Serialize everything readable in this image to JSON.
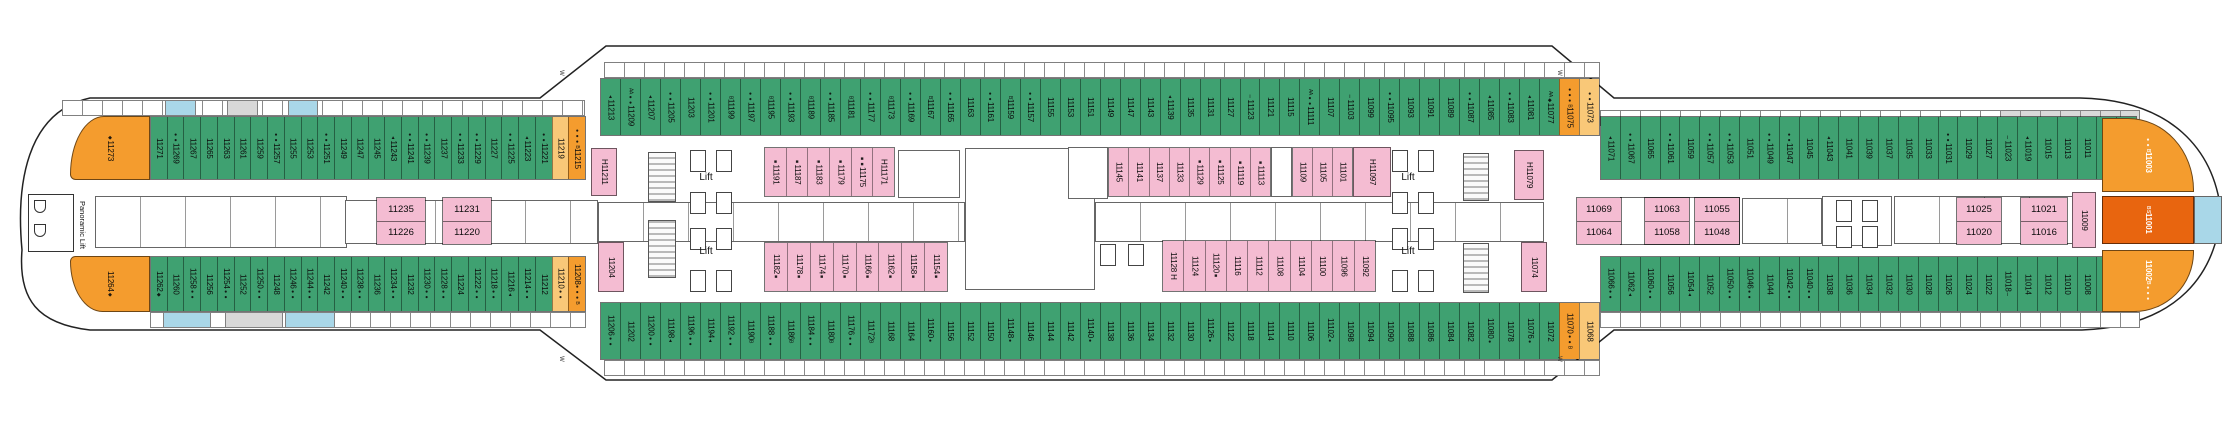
{
  "labels": {
    "lift": "Lift",
    "panoramic_lift": "Panoramic Lift",
    "w_marker": "W"
  },
  "colors": {
    "green": "#3FA171",
    "pink": "#F4BCD2",
    "orange": "#F49C2E",
    "lightorange": "#F9C878",
    "darkorange": "#E8650F",
    "blue": "#A9D7E8",
    "grey": "#D8D8D8"
  },
  "stern": {
    "top": {
      "n": "11273",
      "m": "◆"
    },
    "bottom": {
      "n": "11264",
      "m": "◆"
    }
  },
  "bow": {
    "top": {
      "n": "11003",
      "m": "●● B"
    },
    "middle": {
      "n": "11001",
      "m": "B S"
    },
    "bottom": {
      "n": "11002",
      "m": "B ●●●"
    }
  },
  "rows": {
    "top_left": {
      "cabins": [
        {
          "n": "11271"
        },
        {
          "n": "11269",
          "m": "●●"
        },
        {
          "n": "11267"
        },
        {
          "n": "11265"
        },
        {
          "n": "11263"
        },
        {
          "n": "11261"
        },
        {
          "n": "11259"
        },
        {
          "n": "11257",
          "m": "●●"
        },
        {
          "n": "11255"
        },
        {
          "n": "11253"
        },
        {
          "n": "11251",
          "m": "●●"
        },
        {
          "n": "11249"
        },
        {
          "n": "11247"
        },
        {
          "n": "11245"
        },
        {
          "n": "11243",
          "m": "▲"
        },
        {
          "n": "11241",
          "m": "●●"
        },
        {
          "n": "11239",
          "m": "●●"
        },
        {
          "n": "11237"
        },
        {
          "n": "11233",
          "m": "●●"
        },
        {
          "n": "11229",
          "m": "●●"
        },
        {
          "n": "11227"
        },
        {
          "n": "11225",
          "m": "●●"
        },
        {
          "n": "11223",
          "m": "▲"
        },
        {
          "n": "11221",
          "m": "●●"
        },
        {
          "n": "11219",
          "c": "lightorange"
        },
        {
          "n": "11215",
          "c": "orange",
          "m": "●●● B"
        }
      ]
    },
    "top_center": {
      "cabins": [
        {
          "n": "11213",
          "m": "▲"
        },
        {
          "n": "11209",
          "m": "AA ●●"
        },
        {
          "n": "11207",
          "m": "▲"
        },
        {
          "n": "11205",
          "m": "●●"
        },
        {
          "n": "11203"
        },
        {
          "n": "11201",
          "m": "●●"
        },
        {
          "n": "11199",
          "m": "B"
        },
        {
          "n": "11197",
          "m": "●●"
        },
        {
          "n": "11195",
          "m": "B"
        },
        {
          "n": "11193",
          "m": "●●"
        },
        {
          "n": "11189",
          "m": "B"
        },
        {
          "n": "11185",
          "m": "●●"
        },
        {
          "n": "11181",
          "m": "B"
        },
        {
          "n": "11177",
          "m": "●●"
        },
        {
          "n": "11173",
          "m": "B"
        },
        {
          "n": "11169",
          "m": "●●"
        },
        {
          "n": "11167",
          "m": "B"
        },
        {
          "n": "11165",
          "m": "●●"
        },
        {
          "n": "11163"
        },
        {
          "n": "11161",
          "m": "●●"
        },
        {
          "n": "11159",
          "m": "B"
        },
        {
          "n": "11157",
          "m": "●●"
        },
        {
          "n": "11155"
        },
        {
          "n": "11153"
        },
        {
          "n": "11151"
        },
        {
          "n": "11149"
        },
        {
          "n": "11147"
        },
        {
          "n": "11143"
        },
        {
          "n": "11139",
          "m": "▲"
        },
        {
          "n": "11135"
        },
        {
          "n": "11131"
        },
        {
          "n": "11127"
        },
        {
          "n": "11123",
          "m": "Ⅰ"
        },
        {
          "n": "11121"
        },
        {
          "n": "11115"
        },
        {
          "n": "11111",
          "m": "AA ●●"
        },
        {
          "n": "11107"
        },
        {
          "n": "11103",
          "m": "Ⅰ"
        },
        {
          "n": "11099"
        },
        {
          "n": "11095",
          "m": "●●"
        },
        {
          "n": "11093"
        },
        {
          "n": "11091"
        },
        {
          "n": "11089"
        },
        {
          "n": "11087",
          "m": "●●"
        },
        {
          "n": "11085",
          "m": "▲"
        },
        {
          "n": "11083",
          "m": "●●"
        },
        {
          "n": "11081",
          "m": "▲"
        },
        {
          "n": "11077",
          "m": "AA ◆"
        },
        {
          "n": "11075",
          "c": "orange",
          "m": "●●● B"
        },
        {
          "n": "11073",
          "c": "lightorange",
          "m": "●●"
        }
      ]
    },
    "top_right": {
      "cabins": [
        {
          "n": "11071",
          "m": "▲"
        },
        {
          "n": "11067",
          "m": "●●"
        },
        {
          "n": "11065"
        },
        {
          "n": "11061",
          "m": "●●"
        },
        {
          "n": "11059"
        },
        {
          "n": "11057",
          "m": "●●"
        },
        {
          "n": "11053",
          "m": "●●"
        },
        {
          "n": "11051"
        },
        {
          "n": "11049",
          "m": "●●"
        },
        {
          "n": "11047",
          "m": "●●"
        },
        {
          "n": "11045"
        },
        {
          "n": "11043",
          "m": "▲"
        },
        {
          "n": "11041"
        },
        {
          "n": "11039"
        },
        {
          "n": "11037"
        },
        {
          "n": "11035"
        },
        {
          "n": "11033"
        },
        {
          "n": "11031",
          "m": "●●"
        },
        {
          "n": "11029"
        },
        {
          "n": "11027"
        },
        {
          "n": "11023",
          "m": "Ⅰ"
        },
        {
          "n": "11019",
          "m": "▲"
        },
        {
          "n": "11015"
        },
        {
          "n": "11013"
        },
        {
          "n": "11011"
        },
        {
          "n": "11007"
        },
        {
          "n": "11005"
        }
      ]
    },
    "bottom_left": {
      "cabins": [
        {
          "n": "11262",
          "m": "◆"
        },
        {
          "n": "11260"
        },
        {
          "n": "11258",
          "m": "●●"
        },
        {
          "n": "11256"
        },
        {
          "n": "11254",
          "m": "●●"
        },
        {
          "n": "11252"
        },
        {
          "n": "11250",
          "m": "●●"
        },
        {
          "n": "11248"
        },
        {
          "n": "11246",
          "m": "●●"
        },
        {
          "n": "11244",
          "m": "●●"
        },
        {
          "n": "11242"
        },
        {
          "n": "11240",
          "m": "●●"
        },
        {
          "n": "11238",
          "m": "●●"
        },
        {
          "n": "11236"
        },
        {
          "n": "11234",
          "m": "●●"
        },
        {
          "n": "11232"
        },
        {
          "n": "11230",
          "m": "●●"
        },
        {
          "n": "11228",
          "m": "●●"
        },
        {
          "n": "11224"
        },
        {
          "n": "11222",
          "m": "●●"
        },
        {
          "n": "11218",
          "m": "●●"
        },
        {
          "n": "11216",
          "m": "▲"
        },
        {
          "n": "11214",
          "m": "●●"
        },
        {
          "n": "11212"
        },
        {
          "n": "11210",
          "c": "lightorange",
          "m": "●●"
        },
        {
          "n": "11208",
          "c": "orange",
          "m": "●●● B"
        }
      ]
    },
    "bottom_center": {
      "cabins": [
        {
          "n": "11206",
          "m": "●●"
        },
        {
          "n": "11202"
        },
        {
          "n": "11200",
          "m": "●●"
        },
        {
          "n": "11198",
          "m": "▲"
        },
        {
          "n": "11196",
          "m": "●●"
        },
        {
          "n": "11194",
          "m": "▲"
        },
        {
          "n": "11192",
          "m": "●●"
        },
        {
          "n": "11190",
          "m": "B"
        },
        {
          "n": "11188",
          "m": "●●"
        },
        {
          "n": "11186",
          "m": "B"
        },
        {
          "n": "11184",
          "m": "●●"
        },
        {
          "n": "11180",
          "m": "B"
        },
        {
          "n": "11176",
          "m": "●●"
        },
        {
          "n": "11172",
          "m": "B"
        },
        {
          "n": "11168"
        },
        {
          "n": "11164"
        },
        {
          "n": "11160",
          "m": "●"
        },
        {
          "n": "11156"
        },
        {
          "n": "11152"
        },
        {
          "n": "11150"
        },
        {
          "n": "11148",
          "m": "●"
        },
        {
          "n": "11146"
        },
        {
          "n": "11144"
        },
        {
          "n": "11142"
        },
        {
          "n": "11140",
          "m": "●"
        },
        {
          "n": "11138"
        },
        {
          "n": "11136"
        },
        {
          "n": "11134"
        },
        {
          "n": "11132"
        },
        {
          "n": "11130"
        },
        {
          "n": "11126",
          "m": "●"
        },
        {
          "n": "11122"
        },
        {
          "n": "11118"
        },
        {
          "n": "11114"
        },
        {
          "n": "11110"
        },
        {
          "n": "11106"
        },
        {
          "n": "11102",
          "m": "●"
        },
        {
          "n": "11098"
        },
        {
          "n": "11094"
        },
        {
          "n": "11090"
        },
        {
          "n": "11088"
        },
        {
          "n": "11086"
        },
        {
          "n": "11084"
        },
        {
          "n": "11082"
        },
        {
          "n": "11080",
          "m": "●"
        },
        {
          "n": "11078"
        },
        {
          "n": "11076",
          "m": "●"
        },
        {
          "n": "11072"
        },
        {
          "n": "11070",
          "c": "orange",
          "m": "●● B"
        },
        {
          "n": "11068",
          "c": "lightorange"
        }
      ]
    },
    "bottom_right": {
      "cabins": [
        {
          "n": "11066",
          "m": "●●"
        },
        {
          "n": "11062",
          "m": "▲"
        },
        {
          "n": "11060",
          "m": "●●"
        },
        {
          "n": "11056"
        },
        {
          "n": "11054",
          "m": "▲"
        },
        {
          "n": "11052"
        },
        {
          "n": "11050",
          "m": "●●"
        },
        {
          "n": "11046",
          "m": "●●"
        },
        {
          "n": "11044"
        },
        {
          "n": "11042",
          "m": "●●"
        },
        {
          "n": "11040",
          "m": "●●"
        },
        {
          "n": "11038"
        },
        {
          "n": "11036"
        },
        {
          "n": "11034"
        },
        {
          "n": "11032"
        },
        {
          "n": "11030"
        },
        {
          "n": "11028"
        },
        {
          "n": "11026"
        },
        {
          "n": "11024"
        },
        {
          "n": "11022"
        },
        {
          "n": "11018",
          "m": "Ⅰ"
        },
        {
          "n": "11014"
        },
        {
          "n": "11012"
        },
        {
          "n": "11010"
        },
        {
          "n": "11008"
        },
        {
          "n": "11006"
        },
        {
          "n": "11004"
        }
      ]
    },
    "upper_pink_left": {
      "cabins": [
        {
          "n": "11191",
          "m": "■"
        },
        {
          "n": "11187",
          "m": "■"
        },
        {
          "n": "11183",
          "m": "■"
        },
        {
          "n": "11179",
          "m": "■"
        },
        {
          "n": "11175",
          "m": "■■"
        },
        {
          "n": "H11171"
        }
      ]
    },
    "upper_pink_right_a": {
      "cabins": [
        {
          "n": "11145"
        },
        {
          "n": "11141"
        },
        {
          "n": "11137"
        },
        {
          "n": "11133"
        },
        {
          "n": "11129",
          "m": "■"
        },
        {
          "n": "11125",
          "m": "■"
        },
        {
          "n": "11119",
          "m": "■"
        },
        {
          "n": "11113",
          "m": "■"
        }
      ]
    },
    "upper_pink_right_b": {
      "cabins": [
        {
          "n": "11109"
        },
        {
          "n": "11105"
        },
        {
          "n": "11101"
        }
      ]
    },
    "lower_pink_left": {
      "cabins": [
        {
          "n": "11182",
          "m": "■"
        },
        {
          "n": "11178",
          "m": "■"
        },
        {
          "n": "11174",
          "m": "■"
        },
        {
          "n": "11170",
          "m": "■"
        },
        {
          "n": "11166",
          "m": "■"
        },
        {
          "n": "11162",
          "m": "■"
        },
        {
          "n": "11158",
          "m": "■"
        },
        {
          "n": "11154",
          "m": "■"
        }
      ]
    },
    "lower_pink_right": {
      "cabins": [
        {
          "n": "11128 H"
        },
        {
          "n": "11124"
        },
        {
          "n": "11120",
          "m": "■"
        },
        {
          "n": "11116"
        },
        {
          "n": "11112"
        },
        {
          "n": "11108"
        },
        {
          "n": "11104"
        },
        {
          "n": "11100"
        },
        {
          "n": "11096"
        },
        {
          "n": "11092"
        }
      ]
    }
  },
  "singles": {
    "h11211": {
      "n": "H11211"
    },
    "c11204": {
      "n": "11204"
    },
    "h11097": {
      "n": "H11097"
    },
    "h11079": {
      "n": "H11079"
    },
    "c11074": {
      "n": "11074"
    },
    "c11009": {
      "n": "11009"
    }
  },
  "pairs": [
    {
      "top": "11235",
      "bottom": "11226"
    },
    {
      "top": "11231",
      "bottom": "11220"
    },
    {
      "top": "11069",
      "bottom": "11064"
    },
    {
      "top": "11063",
      "bottom": "11058"
    },
    {
      "top": "11055",
      "bottom": "11048"
    },
    {
      "top": "11025",
      "bottom": "11020"
    },
    {
      "top": "11021",
      "bottom": "11016"
    }
  ]
}
